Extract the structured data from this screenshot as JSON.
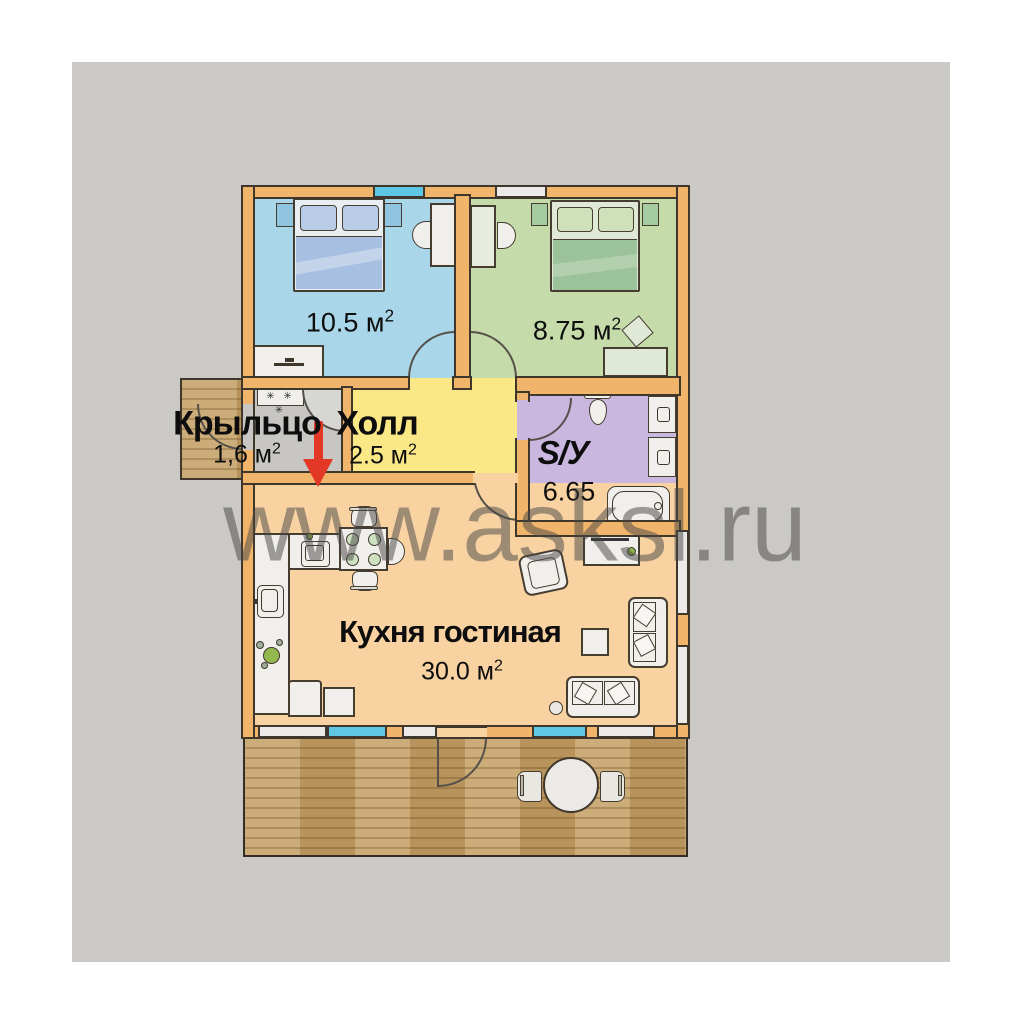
{
  "watermark": {
    "text": "www.asksl.ru"
  },
  "rooms": {
    "bedroom1": {
      "area": "10.5 м",
      "area_sup": "2"
    },
    "bedroom2": {
      "area": "8.75 м",
      "area_sup": "2"
    },
    "porch": {
      "name": "Крыльцо",
      "area": "1,6 м",
      "area_sup": "2"
    },
    "hall": {
      "name": "Холл",
      "area": "2.5 м",
      "area_sup": "2"
    },
    "bathroom": {
      "name": "S/У",
      "area": "6.65"
    },
    "kitchen_living": {
      "name": "Кухня гостиная",
      "area": "30.0 м",
      "area_sup": "2"
    }
  },
  "symbols": {
    "coat_hooks": "✳ ✳ ✳"
  },
  "colors": {
    "bg_gray": "#cac9c5",
    "wall": "#f0b46b",
    "bedroom1_floor": "#a9d7e9",
    "bedroom2_floor": "#c5dcaa",
    "hall_floor": "#fae886",
    "vestibule_floor": "#c7c6c3",
    "bathroom_floor": "#c9b7e0",
    "kitchen_floor": "#f8d3a1",
    "wood": "#c4a168",
    "window": "#5ec7e3",
    "window_white": "#eceae8",
    "furniture": "#f0efec",
    "bed1_blanket": "#a7c0e2",
    "bed1_pillow": "#b9cde8",
    "bed2_blanket": "#9cc29a",
    "bed2_pillow": "#cfe0ba",
    "arrow": "#e33826",
    "watermark": "#464646"
  }
}
